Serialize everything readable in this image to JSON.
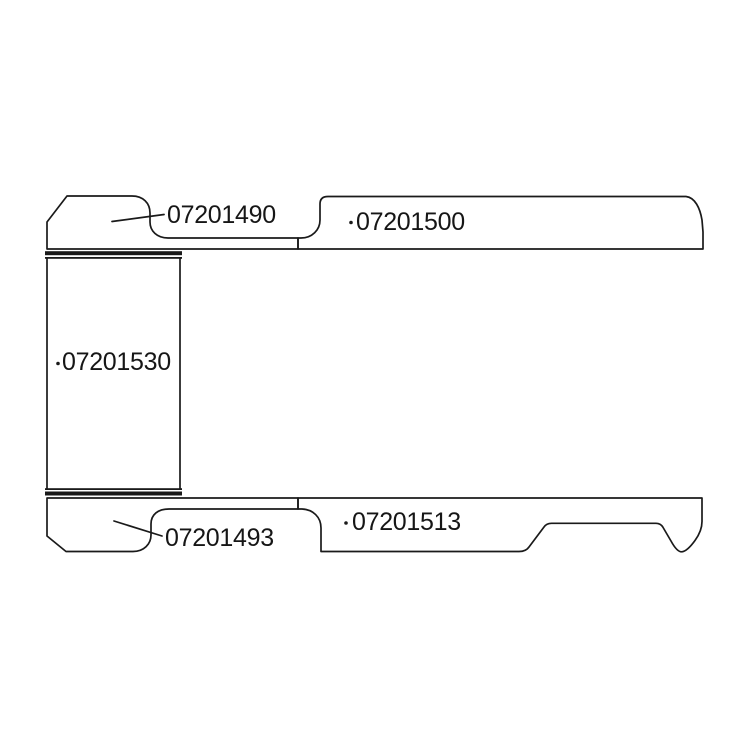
{
  "diagram": {
    "background": "#ffffff",
    "line_color": "#1a1a1a",
    "parts": [
      {
        "label": "07201490"
      },
      {
        "label": "07201500"
      },
      {
        "label": "07201530"
      },
      {
        "label": "07201493"
      },
      {
        "label": "07201513"
      }
    ]
  }
}
